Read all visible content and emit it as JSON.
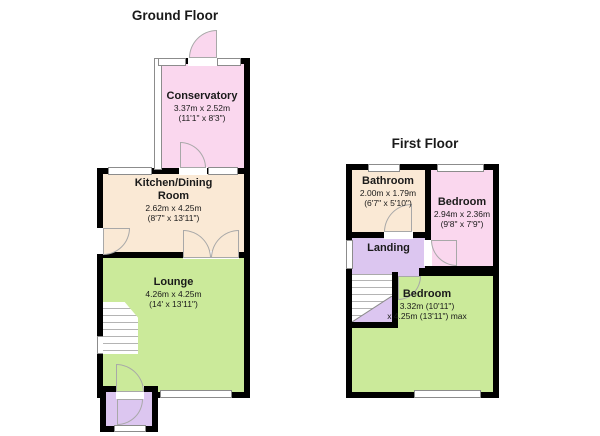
{
  "colors": {
    "pink": "#FAD7EE",
    "cream": "#FAE9D5",
    "green": "#CBEA9A",
    "purple": "#DCC6F0",
    "wall": "#000000",
    "winframe": "#8C8C8C",
    "arc": "#A8A8A8"
  },
  "ground_floor": {
    "title": "Ground Floor",
    "rooms": {
      "conservatory": {
        "name": "Conservatory",
        "metric": "3.37m x 2.52m",
        "imperial": "(11'1\" x 8'3\")"
      },
      "kitchen": {
        "name_line1": "Kitchen/Dining",
        "name_line2": "Room",
        "metric": "2.62m x 4.25m",
        "imperial": "(8'7\" x 13'11\")"
      },
      "lounge": {
        "name": "Lounge",
        "metric": "4.26m x 4.25m",
        "imperial": "(14' x 13'11\")"
      }
    }
  },
  "first_floor": {
    "title": "First Floor",
    "rooms": {
      "bathroom": {
        "name": "Bathroom",
        "metric": "2.00m x 1.79m",
        "imperial": "(6'7\" x 5'10\")"
      },
      "bedroom1": {
        "name": "Bedroom",
        "metric": "2.94m x 2.36m",
        "imperial": "(9'8\" x 7'9\")"
      },
      "landing": {
        "name": "Landing"
      },
      "bedroom2": {
        "name": "Bedroom",
        "metric": "3.32m (10'11\")",
        "imperial": "x 4.25m (13'11\") max"
      }
    }
  }
}
